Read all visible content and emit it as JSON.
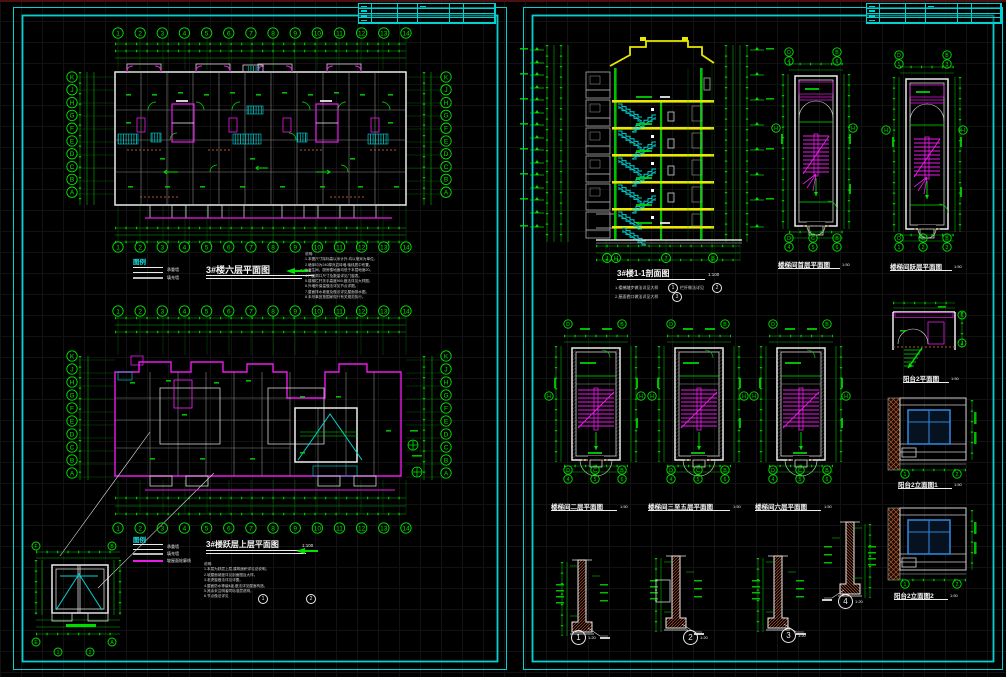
{
  "colors": {
    "border": "#00d2d2",
    "green": "#00e400",
    "magenta": "#ea1aea",
    "cyan": "#00d4d4",
    "yellow": "#e8e800",
    "white": "#ececec",
    "gray": "#9a9a9a",
    "brick": "#b0572f",
    "blue": "#2b82d8"
  },
  "left_sheet": {
    "plan1": {
      "title": "3#楼六层平面图",
      "scale": "1:100"
    },
    "legend1": {
      "header": "图例",
      "items": [
        {
          "label": "承重墙"
        },
        {
          "label": "填充墙"
        }
      ]
    },
    "notes1": {
      "body": "说明:\n1.本图尺寸除标高以米计外,均以毫米为单位。\n2.墙体均为240厚页岩砖墙,轴线居中布置。\n3.卫生间、厨房楼地面均低于本层地面20。\n4.门窗洞口尺寸及数量详见门窗表。\n5.楼梯栏杆扶手高度900,做法详见大样图。\n6.外墙外保温做法详见节点详图。\n7.屋面排水坡度及做法详见屋面排水图。\n8.未尽事宜按国家现行有关规范执行。"
    },
    "plan2": {
      "title": "3#楼跃层上层平面图",
      "scale": "1:100"
    },
    "legend2": {
      "header": "图例",
      "items": [
        {
          "label": "承重墙"
        },
        {
          "label": "填充墙"
        },
        {
          "label": "坡屋面轮廓线"
        }
      ]
    },
    "notes2": {
      "body": "说明:\n1.本层为跃层上层,建筑面积详见总说明。\n2.坡屋面坡度详见剖面图及大样。\n3.老虎窗做法详见详图。\n4.屋面防水等级Ⅱ级,做法详见屋面构造。\n5.其余未注明者同标准层说明。\n6.节点做法详见"
    }
  },
  "right_sheet": {
    "section": {
      "title": "3#楼1-1剖面图",
      "scale": "1:100",
      "note1": "1.楼梯踏步做法详见大样",
      "note1_ref1": "1",
      "note1b": "栏杆做法详见",
      "note1_ref2": "2",
      "note2": "2.屋面檐口做法详见大样",
      "note2_ref": "3"
    },
    "stair_top": [
      {
        "title": "楼梯间首层平面图",
        "scale": "1:50"
      },
      {
        "title": "楼梯间跃层平面图",
        "scale": "1:50"
      }
    ],
    "stair_bottom": [
      {
        "title": "楼梯间二层平面图",
        "scale": "1:50"
      },
      {
        "title": "楼梯间三至五层平面图",
        "scale": "1:50"
      },
      {
        "title": "楼梯间六层平面图",
        "scale": "1:50"
      }
    ],
    "balcony": {
      "plan_title": "阳台2平面图",
      "elev1_title": "阳台2立面图1",
      "elev2_title": "阳台2立面图2",
      "scale": "1:50"
    },
    "wall_details": [
      {
        "num": "1",
        "scale": "1:20"
      },
      {
        "num": "2",
        "scale": "1:20"
      },
      {
        "num": "3",
        "scale": "1:20"
      },
      {
        "num": "4",
        "scale": "1:20"
      }
    ]
  },
  "refs2": {
    "a": "1",
    "b": "2"
  },
  "bubble_groups": [
    {
      "x": 118,
      "y": 33,
      "dx": 22.15,
      "dy": 0,
      "r": 5.2,
      "labels": [
        "1",
        "2",
        "3",
        "4",
        "5",
        "6",
        "7",
        "8",
        "9",
        "10",
        "11",
        "12",
        "13",
        "14"
      ]
    },
    {
      "x": 118,
      "y": 247,
      "dx": 22.15,
      "dy": 0,
      "r": 5.2,
      "labels": [
        "1",
        "2",
        "3",
        "4",
        "5",
        "6",
        "7",
        "8",
        "9",
        "10",
        "11",
        "12",
        "13",
        "14"
      ]
    },
    {
      "x": 72,
      "y": 77,
      "dx": 0,
      "dy": 12.8,
      "r": 5.2,
      "labels": [
        "K",
        "J",
        "H",
        "G",
        "F",
        "E",
        "D",
        "C",
        "B",
        "A"
      ]
    },
    {
      "x": 446,
      "y": 77,
      "dx": 0,
      "dy": 12.8,
      "r": 5.2,
      "labels": [
        "K",
        "J",
        "H",
        "G",
        "F",
        "E",
        "D",
        "C",
        "B",
        "A"
      ]
    },
    {
      "x": 118,
      "y": 311,
      "dx": 22.15,
      "dy": 0,
      "r": 5.2,
      "labels": [
        "1",
        "2",
        "3",
        "4",
        "5",
        "6",
        "7",
        "8",
        "9",
        "10",
        "11",
        "12",
        "13",
        "14"
      ]
    },
    {
      "x": 118,
      "y": 528,
      "dx": 22.15,
      "dy": 0,
      "r": 5.2,
      "labels": [
        "1",
        "2",
        "3",
        "4",
        "5",
        "6",
        "7",
        "8",
        "9",
        "10",
        "11",
        "12",
        "13",
        "14"
      ]
    },
    {
      "x": 72,
      "y": 356,
      "dx": 0,
      "dy": 13,
      "r": 5.2,
      "labels": [
        "K",
        "J",
        "H",
        "G",
        "F",
        "E",
        "D",
        "C",
        "B",
        "A"
      ]
    },
    {
      "x": 446,
      "y": 356,
      "dx": 0,
      "dy": 13,
      "r": 5.2,
      "labels": [
        "K",
        "J",
        "H",
        "G",
        "F",
        "E",
        "D",
        "C",
        "B",
        "A"
      ]
    },
    {
      "x": 36,
      "y": 546,
      "dx": 76,
      "dy": 0,
      "r": 4,
      "labels": [
        "F",
        "B"
      ]
    },
    {
      "x": 36,
      "y": 642,
      "dx": 76,
      "dy": 0,
      "r": 4,
      "labels": [
        "E",
        "A"
      ]
    },
    {
      "x": 58,
      "y": 652,
      "dx": 32,
      "dy": 0,
      "r": 4,
      "labels": [
        "1",
        "2"
      ]
    },
    {
      "x": 607,
      "y": 258,
      "dx": 9,
      "dy": 0,
      "r": 4.5,
      "labels": [
        "J",
        "H"
      ]
    },
    {
      "x": 666,
      "y": 258,
      "dx": 0,
      "dy": 0,
      "r": 4.5,
      "labels": [
        "7"
      ]
    },
    {
      "x": 713,
      "y": 258,
      "dx": 0,
      "dy": 0,
      "r": 4.5,
      "labels": [
        "B"
      ]
    },
    {
      "x": 789,
      "y": 52,
      "dx": 48,
      "dy": 0,
      "r": 4.2,
      "labels": [
        "D",
        "B"
      ]
    },
    {
      "x": 789,
      "y": 61,
      "dx": 48,
      "dy": 0,
      "r": 4.2,
      "labels": [
        "4",
        "6"
      ]
    },
    {
      "x": 789,
      "y": 238,
      "dx": 24,
      "dy": 0,
      "r": 4.2,
      "labels": [
        "D",
        "C",
        "B"
      ]
    },
    {
      "x": 789,
      "y": 247,
      "dx": 24,
      "dy": 0,
      "r": 4.2,
      "labels": [
        "4",
        "5",
        "6"
      ]
    },
    {
      "x": 776,
      "y": 128,
      "dx": 0,
      "dy": 0,
      "r": 4.2,
      "labels": [
        "H"
      ]
    },
    {
      "x": 853,
      "y": 128,
      "dx": 0,
      "dy": 0,
      "r": 4.2,
      "labels": [
        "H"
      ]
    },
    {
      "x": 899,
      "y": 55,
      "dx": 48,
      "dy": 0,
      "r": 4.2,
      "labels": [
        "D",
        "B"
      ]
    },
    {
      "x": 899,
      "y": 64,
      "dx": 48,
      "dy": 0,
      "r": 4.2,
      "labels": [
        "1",
        "3"
      ]
    },
    {
      "x": 899,
      "y": 238,
      "dx": 24,
      "dy": 0,
      "r": 4.2,
      "labels": [
        "D",
        "C",
        "B"
      ]
    },
    {
      "x": 899,
      "y": 247,
      "dx": 24,
      "dy": 0,
      "r": 4.2,
      "labels": [
        "1",
        "2",
        "3"
      ]
    },
    {
      "x": 886,
      "y": 130,
      "dx": 0,
      "dy": 0,
      "r": 4.2,
      "labels": [
        "H"
      ]
    },
    {
      "x": 963,
      "y": 130,
      "dx": 0,
      "dy": 0,
      "r": 4.2,
      "labels": [
        "H"
      ]
    },
    {
      "x": 568,
      "y": 324,
      "dx": 54,
      "dy": 0,
      "r": 4.2,
      "labels": [
        "D",
        "B"
      ]
    },
    {
      "x": 568,
      "y": 470,
      "dx": 27,
      "dy": 0,
      "r": 4.2,
      "labels": [
        "D",
        "C",
        "B"
      ]
    },
    {
      "x": 568,
      "y": 479,
      "dx": 27,
      "dy": 0,
      "r": 4.2,
      "labels": [
        "4",
        "5",
        "6"
      ]
    },
    {
      "x": 549,
      "y": 396,
      "dx": 0,
      "dy": 0,
      "r": 4.2,
      "labels": [
        "H"
      ]
    },
    {
      "x": 641,
      "y": 396,
      "dx": 0,
      "dy": 0,
      "r": 4.2,
      "labels": [
        "H"
      ]
    },
    {
      "x": 671,
      "y": 324,
      "dx": 54,
      "dy": 0,
      "r": 4.2,
      "labels": [
        "D",
        "B"
      ]
    },
    {
      "x": 671,
      "y": 470,
      "dx": 27,
      "dy": 0,
      "r": 4.2,
      "labels": [
        "D",
        "C",
        "B"
      ]
    },
    {
      "x": 671,
      "y": 479,
      "dx": 27,
      "dy": 0,
      "r": 4.2,
      "labels": [
        "4",
        "5",
        "6"
      ]
    },
    {
      "x": 652,
      "y": 396,
      "dx": 0,
      "dy": 0,
      "r": 4.2,
      "labels": [
        "H"
      ]
    },
    {
      "x": 744,
      "y": 396,
      "dx": 0,
      "dy": 0,
      "r": 4.2,
      "labels": [
        "H"
      ]
    },
    {
      "x": 773,
      "y": 324,
      "dx": 54,
      "dy": 0,
      "r": 4.2,
      "labels": [
        "D",
        "B"
      ]
    },
    {
      "x": 773,
      "y": 470,
      "dx": 27,
      "dy": 0,
      "r": 4.2,
      "labels": [
        "D",
        "C",
        "B"
      ]
    },
    {
      "x": 773,
      "y": 479,
      "dx": 27,
      "dy": 0,
      "r": 4.2,
      "labels": [
        "4",
        "5",
        "6"
      ]
    },
    {
      "x": 754,
      "y": 396,
      "dx": 0,
      "dy": 0,
      "r": 4.2,
      "labels": [
        "H"
      ]
    },
    {
      "x": 846,
      "y": 396,
      "dx": 0,
      "dy": 0,
      "r": 4.2,
      "labels": [
        "H"
      ]
    },
    {
      "x": 962,
      "y": 315,
      "dx": 0,
      "dy": 0,
      "r": 4,
      "labels": [
        "K"
      ]
    },
    {
      "x": 962,
      "y": 343,
      "dx": 0,
      "dy": 0,
      "r": 4,
      "labels": [
        "J"
      ]
    },
    {
      "x": 905,
      "y": 474,
      "dx": 52,
      "dy": 0,
      "r": 4.2,
      "labels": [
        "1",
        "2"
      ]
    },
    {
      "x": 905,
      "y": 584,
      "dx": 52,
      "dy": 0,
      "r": 4.2,
      "labels": [
        "1",
        "2"
      ]
    }
  ]
}
